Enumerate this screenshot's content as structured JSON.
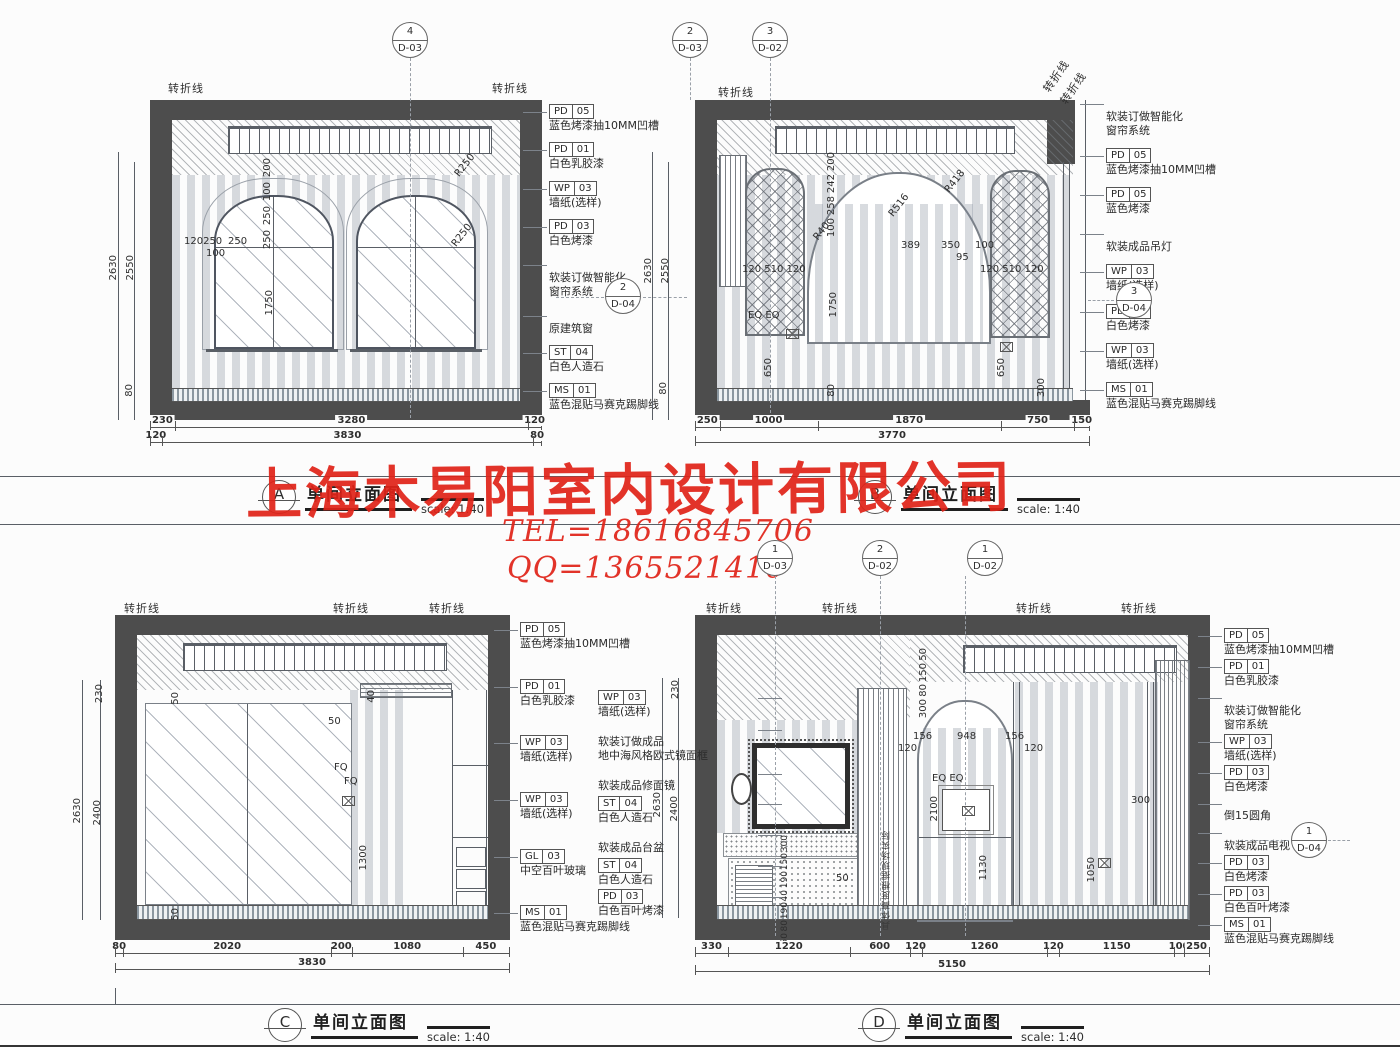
{
  "watermark": {
    "company": "上海木易阳室内设计有限公司",
    "tel": "TEL=18616845706",
    "qq": "QQ=1365521410"
  },
  "common": {
    "fold_line": "转折线",
    "elev_title": "单间立面图",
    "scale": "scale: 1:40"
  },
  "titles": [
    {
      "letter": "A"
    },
    {
      "letter": "B"
    },
    {
      "letter": "C"
    },
    {
      "letter": "D"
    }
  ],
  "drawings": {
    "A": {
      "refs": [
        {
          "n": "4",
          "s": "D-03"
        }
      ],
      "side_circle": {
        "n": "2",
        "s": "D-04"
      },
      "callouts": [
        {
          "c1": "PD",
          "c2": "05",
          "t": "蓝色烤漆抽10MM凹槽"
        },
        {
          "c1": "PD",
          "c2": "01",
          "t": "白色乳胶漆"
        },
        {
          "c1": "WP",
          "c2": "03",
          "t": "墙纸(选样)"
        },
        {
          "c1": "PD",
          "c2": "03",
          "t": "白色烤漆"
        },
        {
          "t": "软装订做智能化",
          "t2": "窗帘系统"
        },
        {
          "t": "原建筑窗"
        },
        {
          "c1": "ST",
          "c2": "04",
          "t": "白色人造石"
        },
        {
          "c1": "MS",
          "c2": "01",
          "t": "蓝色混贴马赛克踢脚线"
        }
      ],
      "dims_left": [
        "2630",
        "2550",
        "80"
      ],
      "chain1": [
        {
          "v": 230
        },
        {
          "v": 3280
        },
        {
          "v": 120
        }
      ],
      "chain2": [
        {
          "v": 120
        },
        {
          "v": 3830
        },
        {
          "v": 80
        }
      ],
      "stack_top": [
        "200",
        "100",
        "250",
        "250"
      ],
      "inner": {
        "w1": "120250",
        "w2": "250",
        "w3": "100",
        "h_win": "1750",
        "r1": "R250",
        "r2": "R250"
      }
    },
    "B": {
      "refs": [
        {
          "n": "2",
          "s": "D-03"
        },
        {
          "n": "3",
          "s": "D-02"
        }
      ],
      "side_circle": {
        "n": "3",
        "s": "D-04"
      },
      "callouts": [
        {
          "t": "软装订做智能化",
          "t2": "窗帘系统"
        },
        {
          "c1": "PD",
          "c2": "05",
          "t": "蓝色烤漆抽10MM凹槽"
        },
        {
          "c1": "PD",
          "c2": "05",
          "t": "蓝色烤漆"
        },
        {
          "t": "软装成品吊灯"
        },
        {
          "c1": "WP",
          "c2": "03",
          "t": "墙纸(选样)"
        },
        {
          "c1": "PD",
          "c2": "03",
          "t": "白色烤漆"
        },
        {
          "c1": "WP",
          "c2": "03",
          "t": "墙纸(选样)"
        },
        {
          "c1": "MS",
          "c2": "01",
          "t": "蓝色混贴马赛克踢脚线"
        }
      ],
      "dims_left": [
        "2630",
        "2550",
        "80"
      ],
      "chain1": [
        {
          "v": 250
        },
        {
          "v": 1000
        },
        {
          "v": 1870
        },
        {
          "v": 750
        },
        {
          "v": 150
        }
      ],
      "chain2": [
        {
          "v": 3770
        }
      ],
      "stack_top": [
        "200",
        "242",
        "258",
        "100"
      ],
      "inner": {
        "r40": "R40",
        "r516": "R516",
        "r418": "R418",
        "seg389": "389",
        "seg350": "350",
        "seg100": "100",
        "d95": "95",
        "lat_l": "120  510  120",
        "lat_r": "120  510  120",
        "eq": "EQ    EQ",
        "h_win": "1750",
        "d650a": "650",
        "d650b": "650",
        "d300": "300",
        "d80": "80"
      }
    },
    "C": {
      "callouts": [
        {
          "c1": "PD",
          "c2": "05",
          "t": "蓝色烤漆抽10MM凹槽"
        },
        {
          "c1": "PD",
          "c2": "01",
          "t": "白色乳胶漆"
        },
        {
          "c1": "WP",
          "c2": "03",
          "t": "墙纸(选样)"
        },
        {
          "c1": "WP",
          "c2": "03",
          "t": "墙纸(选样)"
        },
        {
          "c1": "GL",
          "c2": "03",
          "t": "中空百叶玻璃"
        },
        {
          "c1": "MS",
          "c2": "01",
          "t": "蓝色混贴马赛克踢脚线"
        }
      ],
      "dims_left": [
        "230",
        "2630",
        "2400"
      ],
      "chain1": [
        {
          "v": 80
        },
        {
          "v": 2020
        },
        {
          "v": 200
        },
        {
          "v": 1080
        },
        {
          "v": 450
        }
      ],
      "chain2": [
        {
          "v": 3830
        }
      ],
      "inner": {
        "d50a": "50",
        "d50b": "50",
        "d40": "40",
        "fq1": "FQ",
        "fq2": "FQ",
        "d1300": "1300",
        "d50c": "50"
      }
    },
    "D": {
      "refs": [
        {
          "n": "1",
          "s": "D-03"
        },
        {
          "n": "2",
          "s": "D-02"
        },
        {
          "n": "1",
          "s": "D-02"
        }
      ],
      "side_circle": {
        "n": "1",
        "s": "D-04"
      },
      "callouts_left": [
        {
          "c1": "WP",
          "c2": "03",
          "t": "墙纸(选样)"
        },
        {
          "t": "软装订做成品",
          "t2": "地中海风格欧式镜面框"
        },
        {
          "t": "软装成品修面镜"
        },
        {
          "c1": "ST",
          "c2": "04",
          "t": "白色人造石"
        },
        {
          "t": "软装成品台盆"
        },
        {
          "c1": "ST",
          "c2": "04",
          "t": "白色人造石"
        },
        {
          "c1": "PD",
          "c2": "03",
          "t": "白色百叶烤漆"
        }
      ],
      "callouts_right": [
        {
          "c1": "PD",
          "c2": "05",
          "t": "蓝色烤漆抽10MM凹槽"
        },
        {
          "c1": "PD",
          "c2": "01",
          "t": "白色乳胶漆"
        },
        {
          "t": "软装订做智能化",
          "t2": "窗帘系统"
        },
        {
          "c1": "WP",
          "c2": "03",
          "t": "墙纸(选样)"
        },
        {
          "c1": "PD",
          "c2": "03",
          "t": "白色烤漆"
        },
        {
          "t": "倒15圆角"
        },
        {
          "t": "软装成品电视"
        },
        {
          "c1": "PD",
          "c2": "03",
          "t": "白色烤漆"
        },
        {
          "c1": "PD",
          "c2": "03",
          "t": "白色百叶烤漆"
        },
        {
          "c1": "MS",
          "c2": "01",
          "t": "蓝色混贴马赛克踢脚线"
        }
      ],
      "dims_left": [
        "230",
        "2630",
        "2400"
      ],
      "chain1": [
        {
          "v": 330
        },
        {
          "v": 1220
        },
        {
          "v": 600
        },
        {
          "v": 120
        },
        {
          "v": 1260
        },
        {
          "v": 120
        },
        {
          "v": 1150
        },
        {
          "v": 100
        },
        {
          "v": 250
        }
      ],
      "chain2": [
        {
          "v": 5150
        }
      ],
      "stack_top": [
        "50",
        "150",
        "80",
        "300"
      ],
      "stack_vanity": [
        "300",
        "150",
        "190",
        "40",
        "190",
        "80",
        "50"
      ],
      "inner": {
        "seg156a": "156",
        "seg948": "948",
        "seg156b": "156",
        "d120a": "120",
        "d120b": "120",
        "eq": "EQ      EQ",
        "d2100": "2100",
        "d300": "300",
        "d1130": "1130",
        "d1050": "1050",
        "d50": "50",
        "panel_note": "具体高度根据现场实际"
      }
    }
  }
}
